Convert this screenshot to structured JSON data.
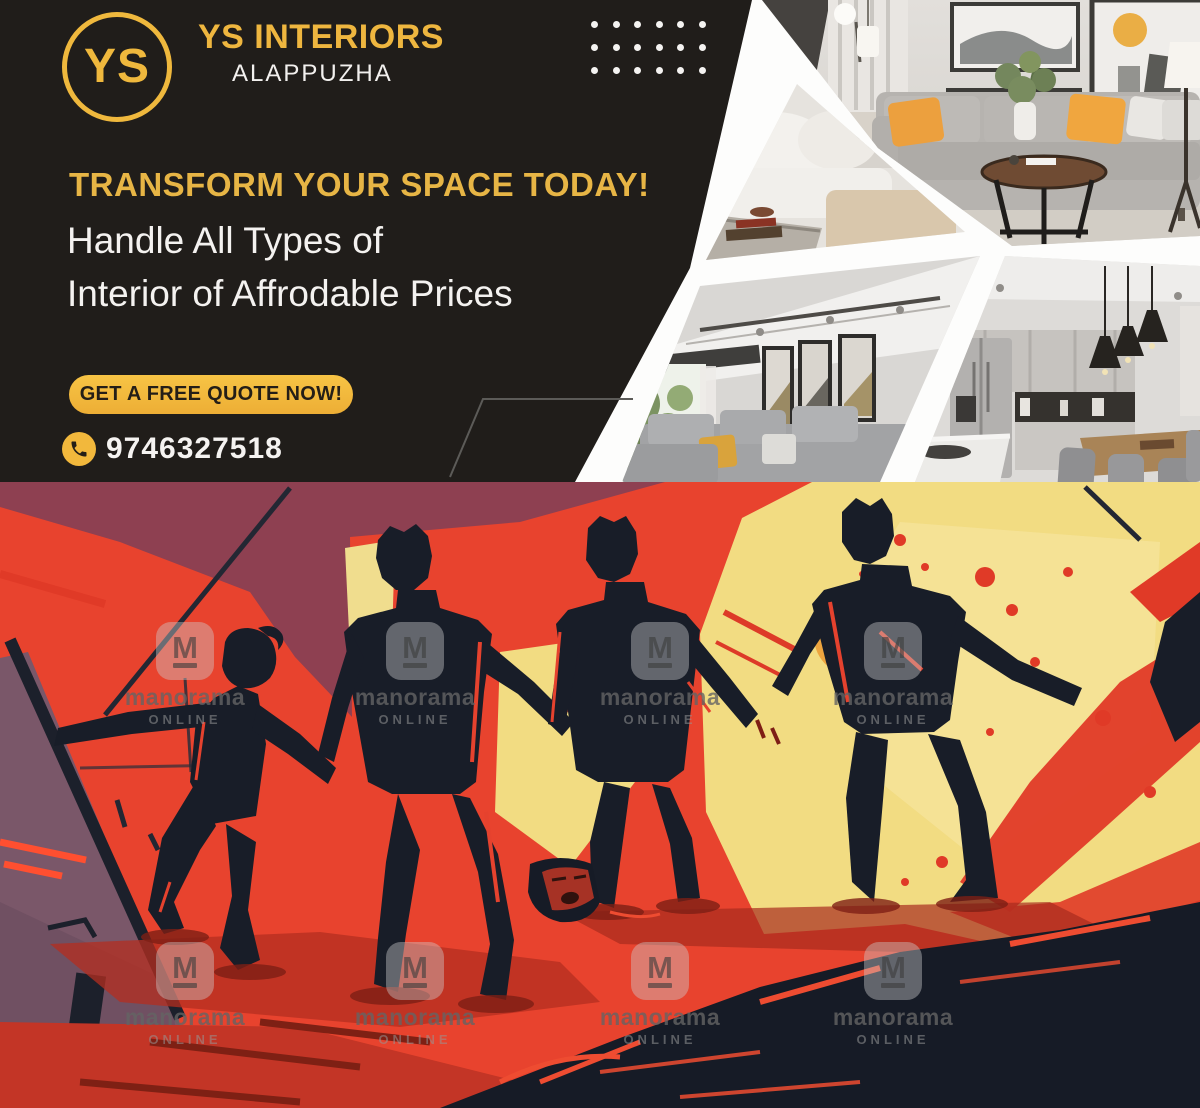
{
  "ad": {
    "logo": {
      "monogram": "YS"
    },
    "brand": {
      "name": "YS INTERIORS",
      "location": "ALAPPUZHA"
    },
    "headline": "TRANSFORM YOUR SPACE TODAY!",
    "subheadline": [
      "Handle All Types of",
      "Interior of Affrodable Prices"
    ],
    "cta_label": "GET A FREE QUOTE NOW!",
    "phone": {
      "number": "9746327518",
      "icon": "phone-icon"
    },
    "decor": {
      "dot_grid": {
        "rows": 3,
        "cols": 6
      }
    },
    "photo_panels": [
      {
        "name": "living-room-gray-sofa-photo"
      },
      {
        "name": "white-sofa-closeup-photo"
      },
      {
        "name": "living-room-art-wall-photo"
      },
      {
        "name": "modern-kitchen-photo"
      }
    ],
    "colors": {
      "background": "#201d1a",
      "gold": "#efb83d",
      "white_text": "#f4f2f0",
      "cta_text": "#241e17"
    }
  },
  "illustration": {
    "description": "comic-style illustration of four silhouetted figures standing over a fallen person",
    "watermark": {
      "monogram": "M",
      "name": "manorama",
      "tagline": "ONLINE"
    },
    "colors": {
      "red": "#e8432e",
      "maroon": "#8e4051",
      "yellow": "#f2db80",
      "purple": "#7a5769",
      "silhouette": "#181d28"
    }
  }
}
